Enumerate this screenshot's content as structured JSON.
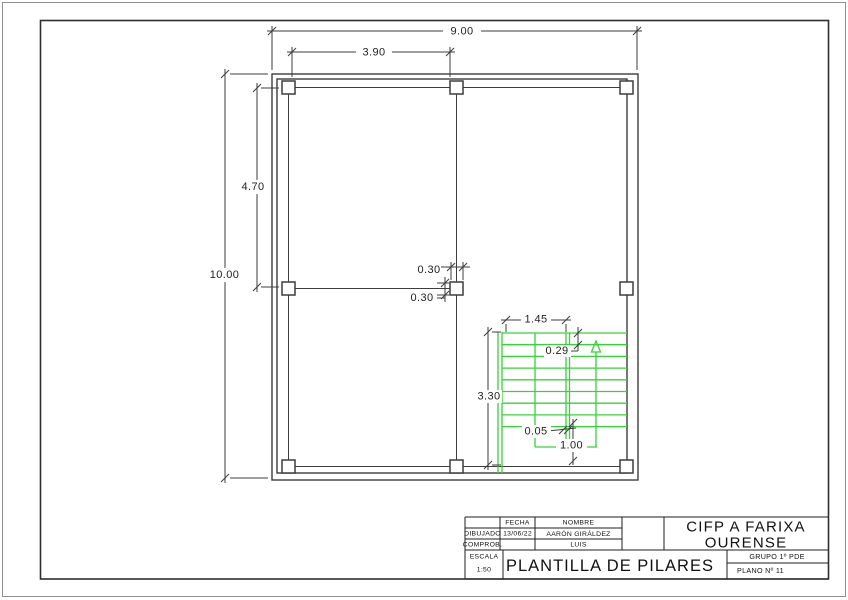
{
  "dimensions": {
    "total_width": "9.00",
    "bay_width": "3.90",
    "total_height": "10.00",
    "bay_height": "4.70",
    "pillar_w": "0.30",
    "pillar_h": "0.30",
    "stair_flight_width": "1.45",
    "tread_depth": "0.29",
    "stair_length": "3.30",
    "stringer_gap": "0.05",
    "bottom_run": "1.00"
  },
  "title_block": {
    "date_header": "FECHA",
    "name_header": "NOMBRE",
    "drawn_label": "DIBUJADO",
    "checked_label": "COMPROB.",
    "date": "13/06/22",
    "drawn_by": "AARÓN GIRÁLDEZ",
    "checked_by": "LUIS",
    "org_line1": "CIFP A FARIXA",
    "org_line2": "OURENSE",
    "scale_label": "ESCALA",
    "scale_value": "1:50",
    "drawing_title": "PLANTILLA DE PILARES",
    "group": "GRUPO 1º PDE",
    "sheet": "PLANO Nº 11"
  },
  "colors": {
    "stair_green": "#35d435",
    "line_dark": "#3d3d3d"
  }
}
